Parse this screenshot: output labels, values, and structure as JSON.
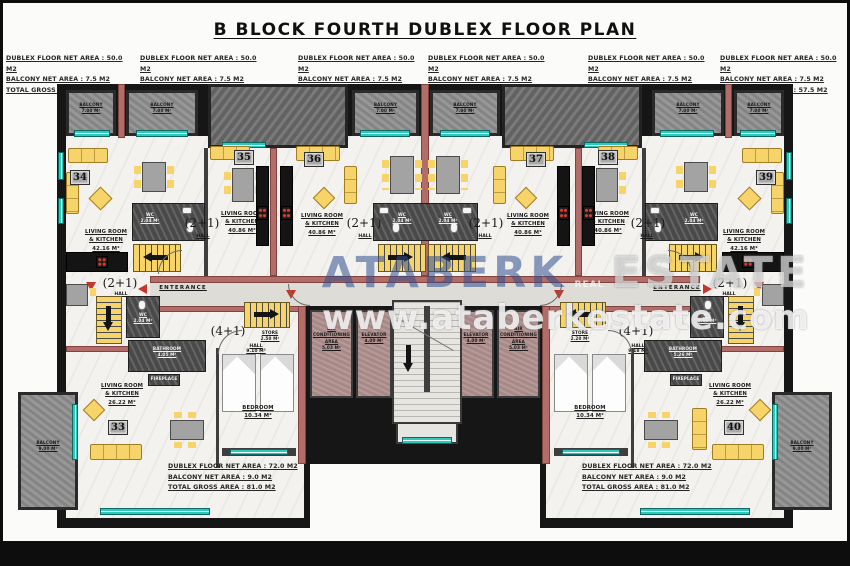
{
  "title": "B BLOCK FOURTH DUBLEX FLOOR PLAN",
  "colors": {
    "teal_window": "#2fc9bc",
    "salmon_wall": "#b26d68",
    "furniture_yellow": "#f6d469",
    "concrete_gray": "#8e8e8e",
    "mauve_room": "#b19290",
    "accent_red": "#c5372a",
    "watermark_blue": "#2f4f8f"
  },
  "stats_top": {
    "floor": "DUBLEX FLOOR NET AREA : 50.0 M2",
    "balcony": "BALCONY NET AREA : 7.5 M2",
    "gross": "TOTAL GROSS AREA : 57.5 M2"
  },
  "stats_bottom": {
    "floor": "DUBLEX FLOOR NET AREA : 72.0 M2",
    "balcony": "BALCONY NET AREA : 9.0 M2",
    "gross": "TOTAL GROSS AREA : 81.0 M2"
  },
  "watermark": {
    "brand": "ATABERK",
    "real": "REAL",
    "estate": "ESTATE",
    "url": "www.ataberkestate.com"
  },
  "units": {
    "u33": "33",
    "u34": "34",
    "u35": "35",
    "u36": "36",
    "u37": "37",
    "u38": "38",
    "u39": "39",
    "u40": "40"
  },
  "labels": {
    "balcony_top": "BALCONY\n7.00 M²",
    "balcony_bottom": "BALCONY\n9.00 M²",
    "living_4216": "LIVING ROOM\n& KITCHEN\n42.16 M²",
    "living_4086": "LIVING ROOM\n& KITCHEN\n40.86 M²",
    "living_2622": "LIVING ROOM\n& KITCHEN\n26.22 M²",
    "type_21": "(2+1)",
    "type_41": "(4+1)",
    "hall": "HALL",
    "hall_910": "HALL\n9.10 M²",
    "hall_918": "HALL\n9.18 M²",
    "wc_204": "WC\n2.04 M²",
    "wc_266": "WC\n2.66 M²",
    "bathroom_405": "BATHROOM\n4.05 M²",
    "bathroom_526": "BATHROOM\n5.26 M²",
    "bedroom_1034": "BEDROOM\n10.34 M²",
    "store_250": "STORE\n2.50 M²",
    "store_220": "STORE\n2.20 M²",
    "ac_area": "AIR\nCONDITIONING\nAREA\n5.03 M²",
    "elevator": "ELEVATOR\n4.00 M²",
    "enterance": "ENTERANCE",
    "fireplace": "FIREPLACE"
  }
}
